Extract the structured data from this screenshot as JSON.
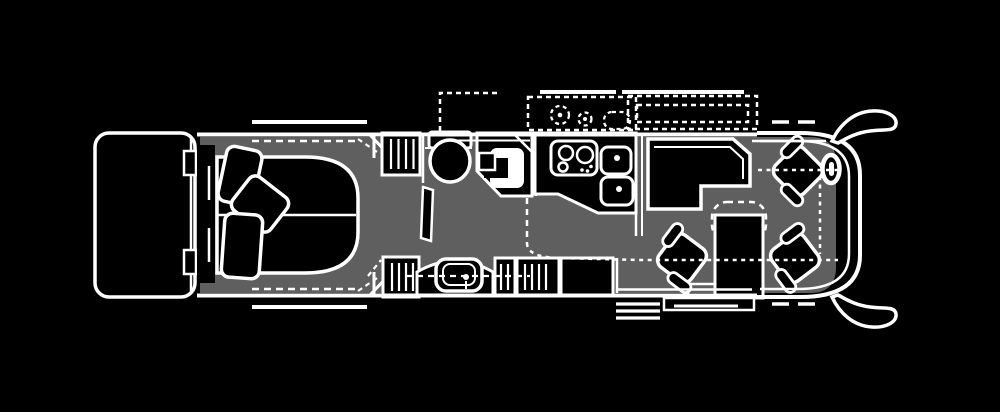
{
  "meta": {
    "title": "motorhome-floor-plan",
    "type": "floor-plan-line-diagram",
    "view": "top-down",
    "front_direction": "right"
  },
  "colors": {
    "background": "#000000",
    "line": "#ffffff",
    "floor": "#5f5f5f",
    "fixture_fill": "#000000"
  },
  "regions": [
    {
      "id": "rear-cap",
      "fixtures": [
        "rear-bumper",
        "wall-notches"
      ]
    },
    {
      "id": "bedroom",
      "fixtures": [
        "headboard-console",
        "bed",
        "pillow-1",
        "pillow-2",
        "pillow-3",
        "slide-out-top",
        "slide-out-bottom"
      ]
    },
    {
      "id": "bathroom",
      "fixtures": [
        "wardrobe-top",
        "toilet",
        "shower",
        "pocket-door",
        "vanity-sink",
        "wardrobe-bottom",
        "linen-cabinet-small",
        "linen-cabinet-large",
        "appliance"
      ]
    },
    {
      "id": "kitchen",
      "fixtures": [
        "counter",
        "cooktop",
        "double-sink",
        "slide-out-dashed-outline",
        "exterior-dashed-fixtures"
      ]
    },
    {
      "id": "living-area",
      "fixtures": [
        "l-shaped-sofa",
        "console-table",
        "lounge-chair",
        "entry-steps",
        "entry-platform",
        "slide-out-dashed-outline"
      ]
    },
    {
      "id": "cockpit",
      "fixtures": [
        "driver-seat",
        "steering-wheel",
        "passenger-seat",
        "windshield",
        "mirror-top",
        "mirror-bottom"
      ]
    }
  ],
  "counts": {
    "pillows": 3,
    "swivel_chairs": 3,
    "side_mirrors": 2,
    "cooktop_burners": 3,
    "sink_bowls": 2,
    "entry_steps": 3
  },
  "line_styles": {
    "wall": "solid",
    "slide_out_boundary": "dashed",
    "walkway": "dotted-dash"
  }
}
